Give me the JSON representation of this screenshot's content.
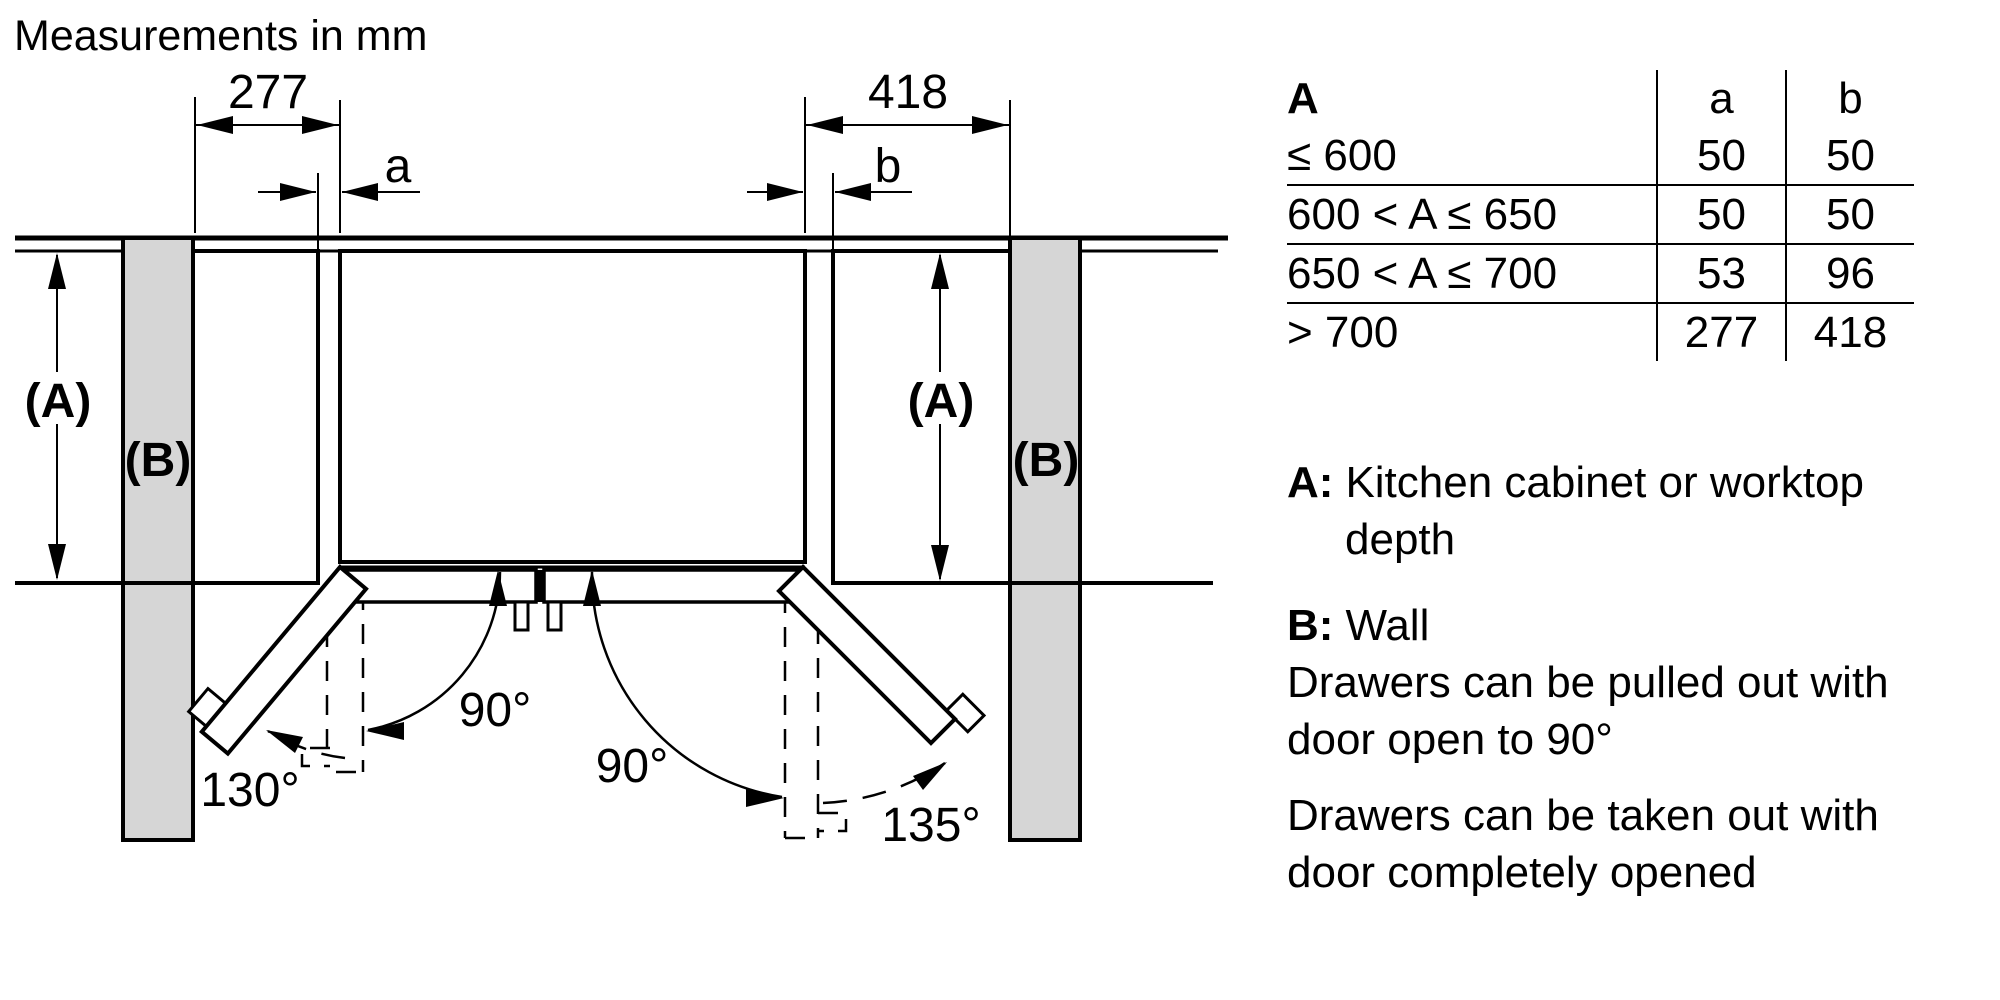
{
  "title": "Measurements in mm",
  "diagram": {
    "dim_left": "277",
    "dim_right": "418",
    "gap_left": "a",
    "gap_right": "b",
    "depth_label_left": "(A)",
    "depth_label_right": "(A)",
    "wall_label_left": "(B)",
    "wall_label_right": "(B)",
    "angle_left_90": "90°",
    "angle_right_90": "90°",
    "angle_left_full": "130°",
    "angle_right_full": "135°"
  },
  "table": {
    "header": {
      "range": "A",
      "a": "a",
      "b": "b"
    },
    "rows": [
      {
        "range": "≤ 600",
        "a": "50",
        "b": "50"
      },
      {
        "range": "600 < A ≤ 650",
        "a": "50",
        "b": "50"
      },
      {
        "range": "650 < A ≤ 700",
        "a": "53",
        "b": "96"
      },
      {
        "range": "> 700",
        "a": "277",
        "b": "418"
      }
    ]
  },
  "legend": {
    "a_key": "A:",
    "a_line1": "Kitchen cabinet or worktop",
    "a_line2": "depth",
    "b_key": "B:",
    "b_text": "Wall",
    "note1_line1": "Drawers can be pulled out with",
    "note1_line2": "door open to 90°",
    "note2_line1": "Drawers can be taken out with",
    "note2_line2": "door completely opened"
  },
  "colors": {
    "wall_fill": "#d6d6d6",
    "line": "#000000",
    "background": "#ffffff"
  }
}
